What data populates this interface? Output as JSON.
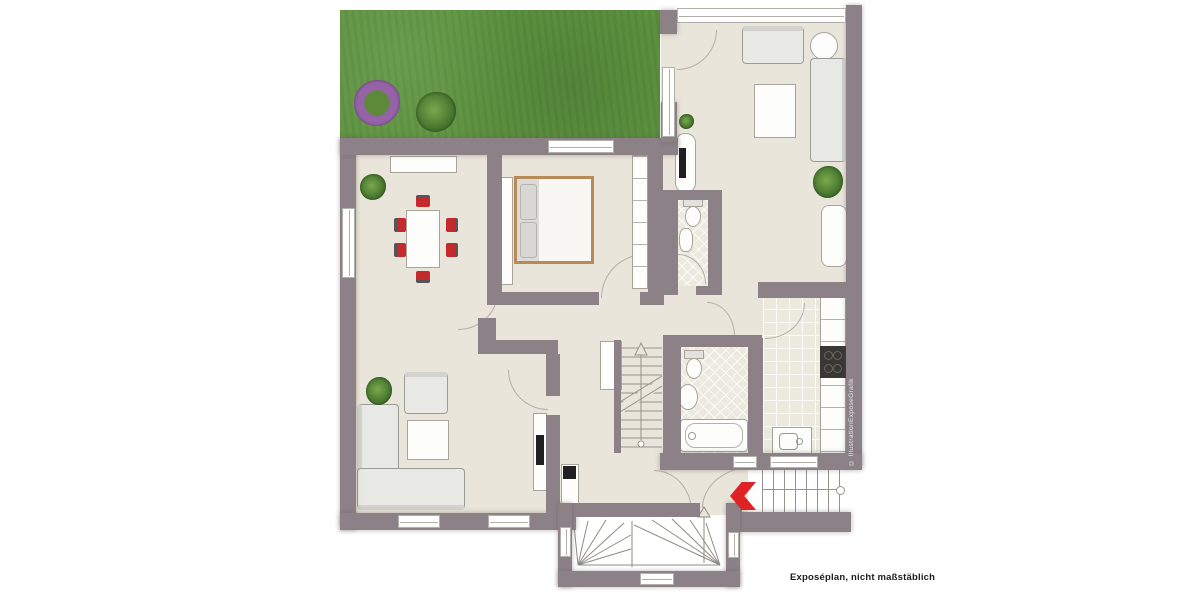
{
  "labels": {
    "footer_note": "Exposéplan, nicht maßstäblich",
    "wall_watermark": "© IllustrationExposeGrafik"
  },
  "markers": {
    "entrance_arrow_icon": "chevron-left-arrow",
    "internal_stairs_icon": "up-arrow",
    "basement_stairs_icon": "up-arrow"
  },
  "colors": {
    "wall": "#8b8187",
    "floor": "#e9e5da",
    "lawn": "#5e9440",
    "tile": "#ece9de",
    "sofa": "#e8e8e4",
    "chair_red": "#c4292b",
    "bed_frame": "#b78a58",
    "arrow_red": "#e02125",
    "line": "#98948c"
  }
}
